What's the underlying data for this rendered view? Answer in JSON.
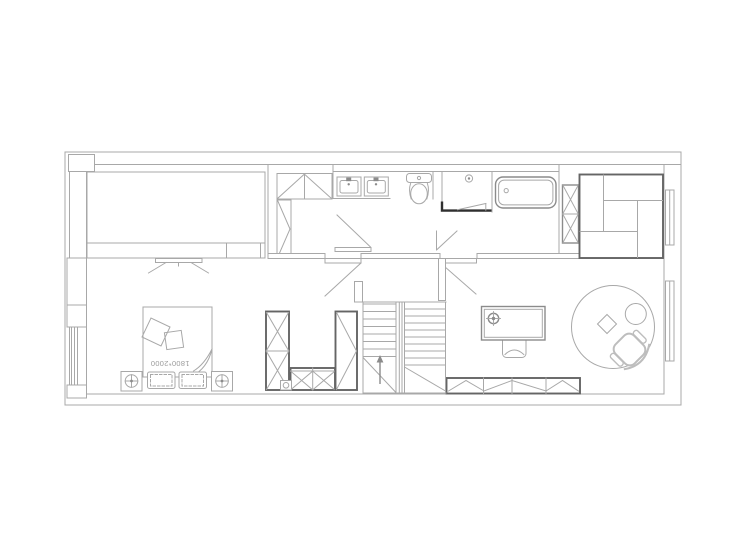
{
  "title": "residential-floor-plan",
  "canvas": {
    "width": 740,
    "height": 550
  },
  "colors": {
    "background": "#ffffff",
    "line_xlight": "#bdbdbd",
    "line_light": "#a8a8a8",
    "line_mid": "#8b8b8b",
    "line_dark": "#656565",
    "accent_black": "#2f2f2f",
    "text_gray": "#9b9b9b"
  },
  "labels": {
    "bed_size": "1800*2000"
  },
  "fixtures": [
    "wardrobe-bank",
    "tv-stand",
    "double-bed",
    "bed-cushions",
    "pillows",
    "nightstand",
    "table-lamp",
    "hall-top-cabinet",
    "hall-side-cabinet",
    "swing-door",
    "double-vanity-sink",
    "faucet",
    "toilet",
    "shower",
    "floor-drain",
    "bathtub",
    "bookshelf",
    "modular-sofa",
    "window",
    "desk",
    "desk-lamp",
    "desk-chair",
    "round-rug",
    "side-table",
    "decor-diamond",
    "office-chair",
    "low-storage-cabinet",
    "staircase",
    "stair-up-arrow",
    "wardrobe",
    "door-stop"
  ]
}
